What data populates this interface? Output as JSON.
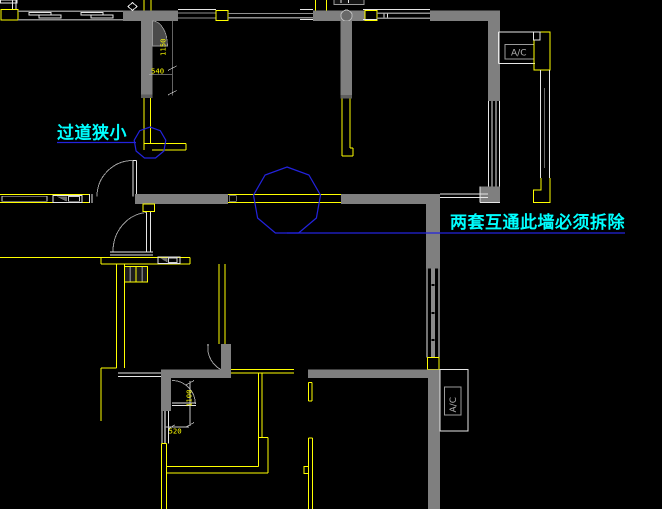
{
  "canvas": {
    "width": 662,
    "height": 509,
    "background": "#000000"
  },
  "annotations": {
    "corridor_note": "过道狭小",
    "demolish_note": "两套互通此墙必须拆除"
  },
  "equipment_labels": {
    "ac_top": "A/C",
    "ac_bottom": "A/C"
  },
  "dimensions": {
    "corridor_depth": "1150",
    "door_offset": "540",
    "opening_width": "1100",
    "wall_offset": "520"
  },
  "colors": {
    "wall_fill": "#7f7f7f",
    "outline_yellow": "#ffff00",
    "window_white": "#e6e6e6",
    "note_cyan": "#00ffff",
    "marker_blue": "#2323dd"
  }
}
